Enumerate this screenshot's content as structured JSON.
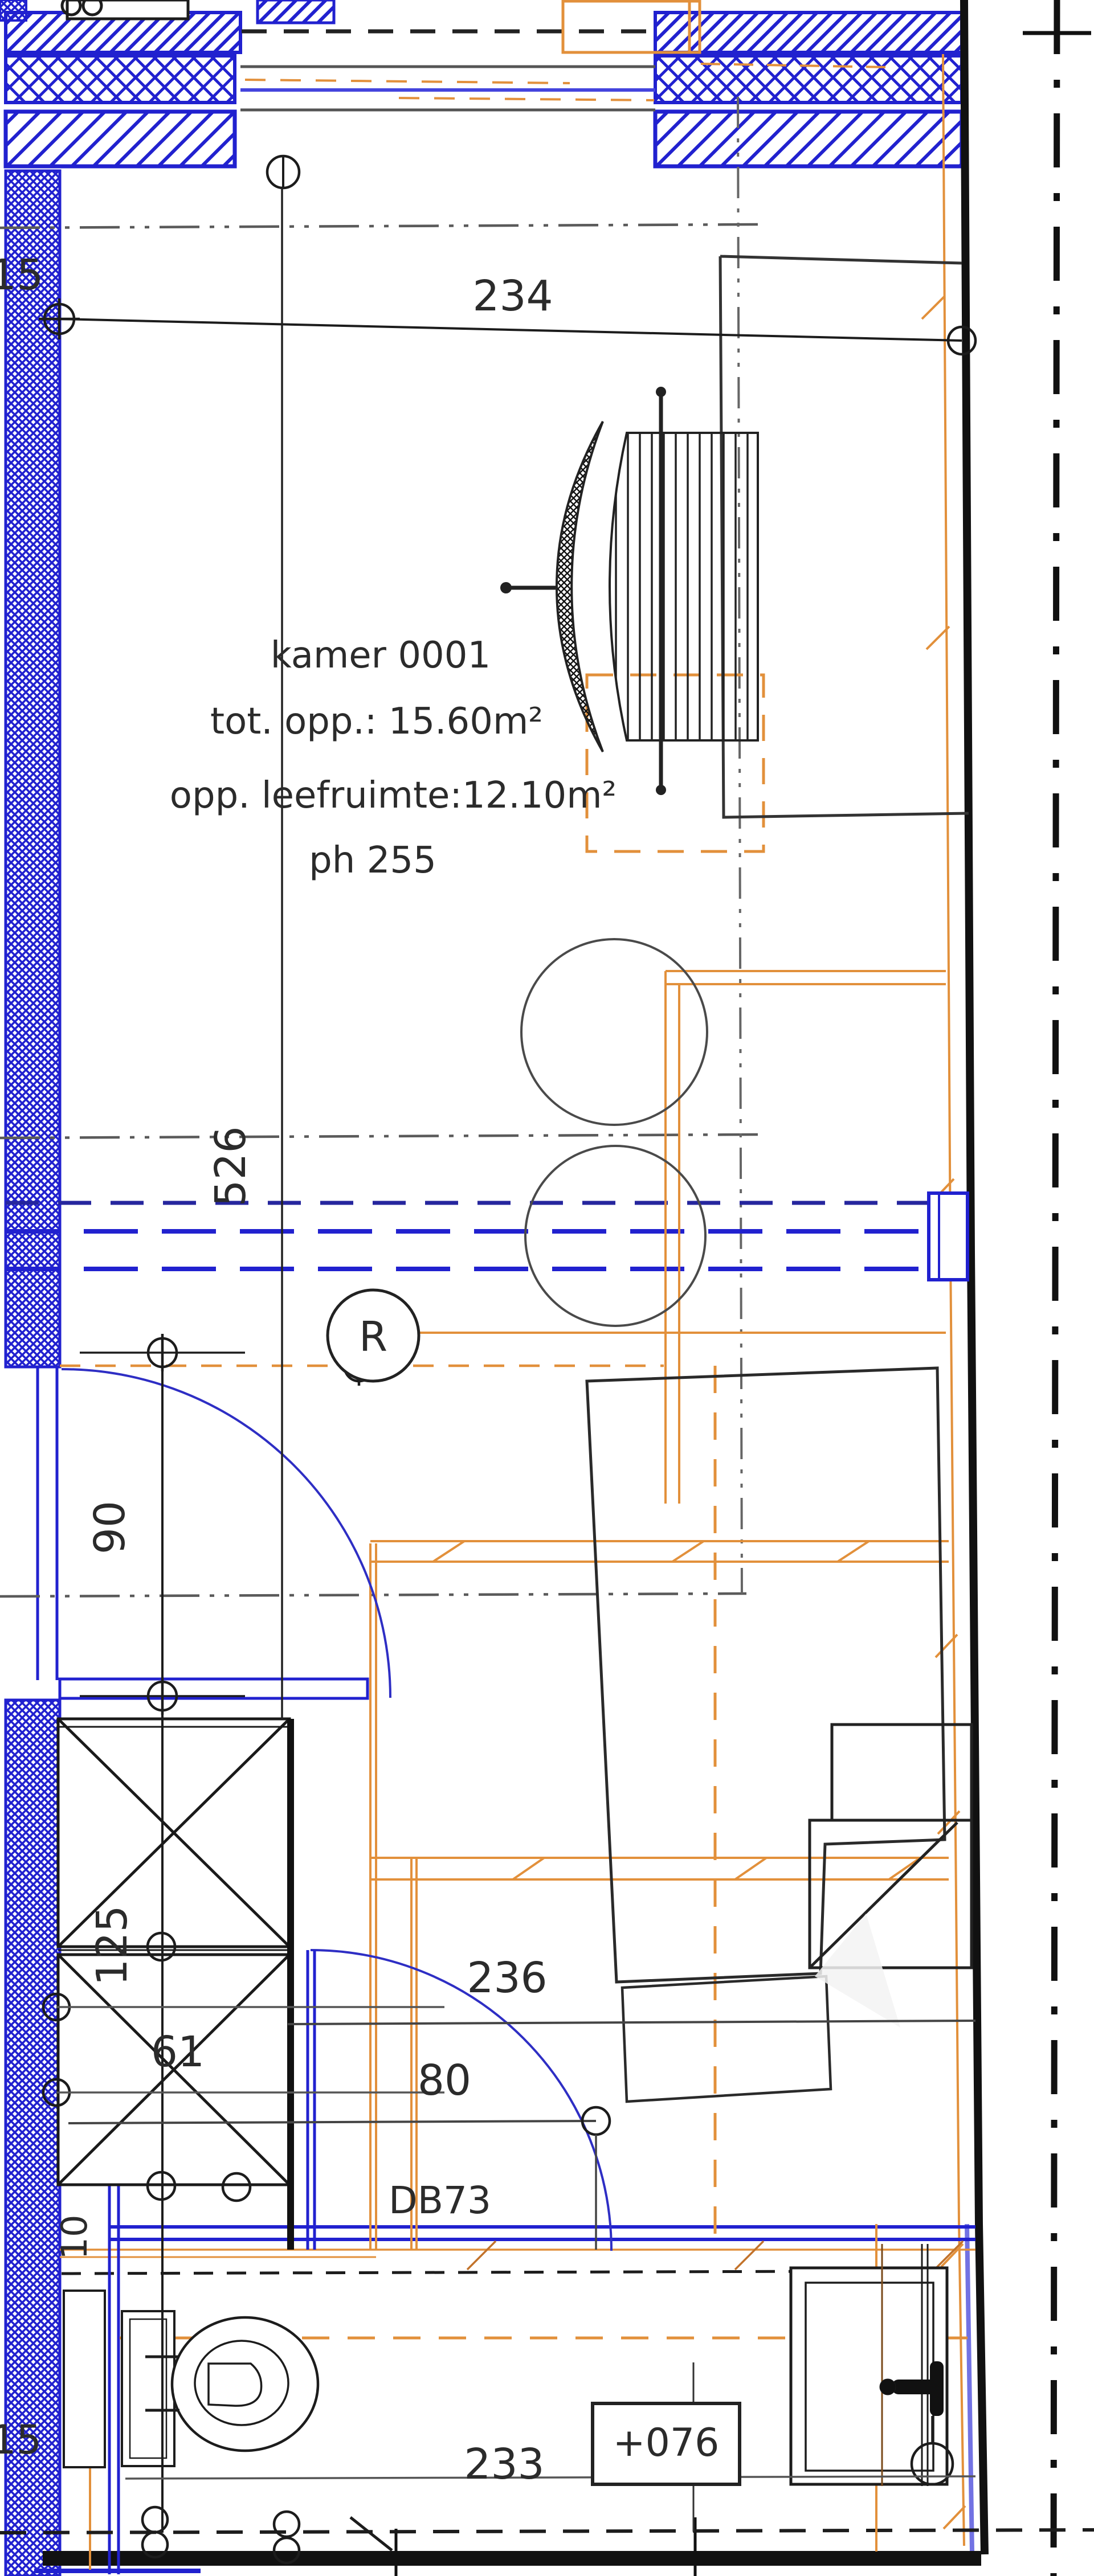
{
  "drawing": {
    "title": "floor plan kamer 0001",
    "room_label": {
      "line1": "kamer 0001",
      "line2": "tot. opp.: 15.60m²",
      "line3": "opp. leefruimte:12.10m²",
      "line4": "ph 255"
    },
    "dimensions": {
      "top_wall_thickness": "15",
      "top_width": "234",
      "room_length": "526",
      "door_width": "90",
      "shaft_depth": "125",
      "shaft2_depth": "61",
      "wall_gap": "10",
      "bath_width": "236",
      "door2_width": "80",
      "door2_code": "DB73",
      "bath_inner_width": "233",
      "floor_level": "+076",
      "bottom_wall_thickness": "15",
      "radiator_symbol": "R"
    },
    "colors": {
      "wall_blue": "#2121cf",
      "door_blue": "#2e2ec4",
      "axis_navy": "#26269e",
      "accent_orange": "#e2903b",
      "line_gray": "#5a5a5a",
      "line_black": "#1c1c1c"
    }
  }
}
